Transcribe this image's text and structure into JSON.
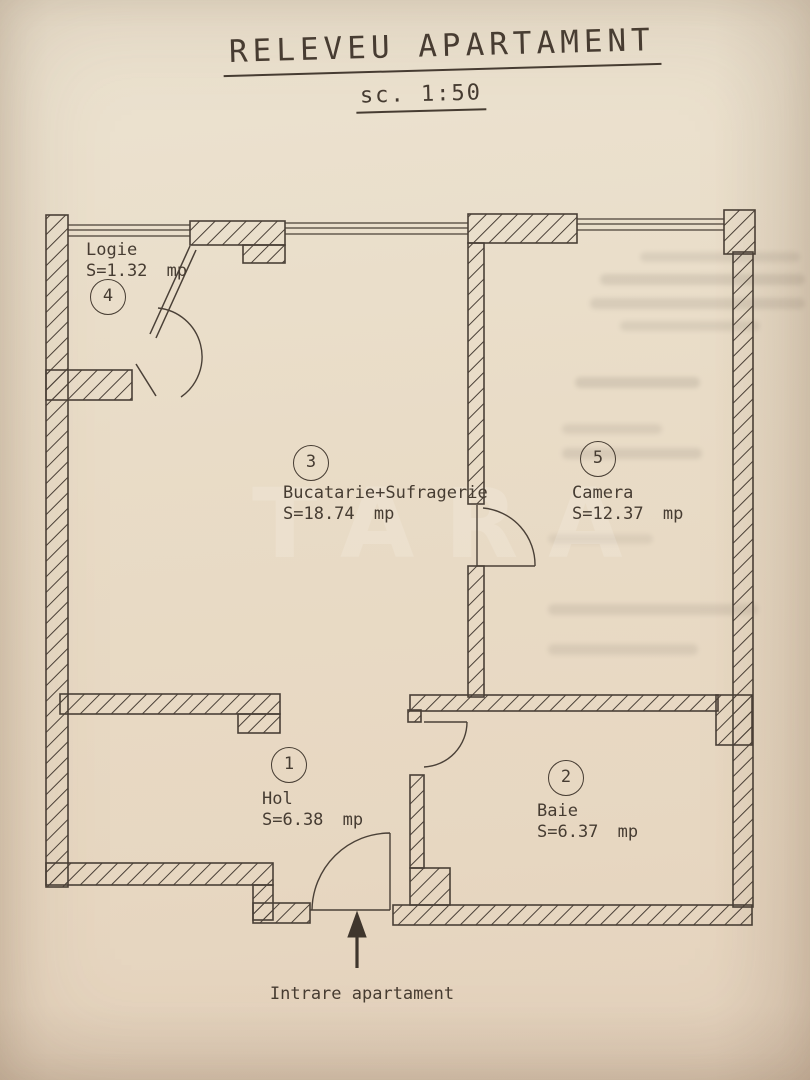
{
  "title": "RELEVEU APARTAMENT",
  "scale_label": "sc. 1:50",
  "rooms": [
    {
      "number": "1",
      "name": "Hol",
      "area": "S=6.38 mp"
    },
    {
      "number": "2",
      "name": "Baie",
      "area": "S=6.37 mp"
    },
    {
      "number": "3",
      "name": "Bucatarie+Sufragerie",
      "area": "S=18.74 mp"
    },
    {
      "number": "4",
      "name": "Logie",
      "area": "S=1.32 mp"
    },
    {
      "number": "5",
      "name": "Camera",
      "area": "S=12.37 mp"
    }
  ],
  "entrance_label": "Intrare apartament",
  "watermark": "TARA",
  "colors": {
    "paper": "#e9dcc7",
    "ink": "#4a4037"
  }
}
